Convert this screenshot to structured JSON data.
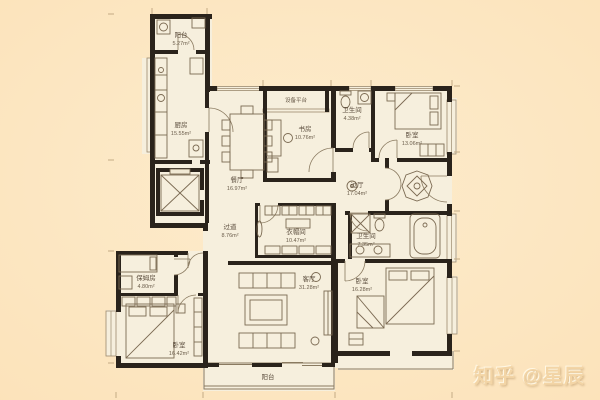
{
  "watermark": {
    "text": "知乎 @星辰"
  },
  "colors": {
    "background": "#fce3bb",
    "paper": "#f6efdd",
    "wall": "#2a231b",
    "furniture_line": "#7b6a52",
    "label_text": "#5c4e3e",
    "watermark_text": "#f3d5a6"
  },
  "plan": {
    "type": "apartment-floor-plan",
    "rooms": [
      {
        "label": "阳台",
        "area": "5.27m²"
      },
      {
        "label": "厨房",
        "area": "15.55m²"
      },
      {
        "label": "设备平台",
        "area": ""
      },
      {
        "label": "书房",
        "area": "10.76m²"
      },
      {
        "label": "卫生间",
        "area": "4.38m²"
      },
      {
        "label": "卧室",
        "area": "13.06m²"
      },
      {
        "label": "餐厅",
        "area": "16.97m²"
      },
      {
        "label": "过厅",
        "area": "17.04m²"
      },
      {
        "label": "过道",
        "area": "8.76m²"
      },
      {
        "label": "衣帽间",
        "area": "10.47m²"
      },
      {
        "label": "卫生间",
        "area": "7.35m²"
      },
      {
        "label": "客厅",
        "area": "31.28m²"
      },
      {
        "label": "卧室",
        "area": "16.28m²"
      },
      {
        "label": "保姆房",
        "area": "4.80m²"
      },
      {
        "label": "卧室",
        "area": "16.42m²"
      },
      {
        "label": "阳台",
        "area": ""
      }
    ]
  }
}
